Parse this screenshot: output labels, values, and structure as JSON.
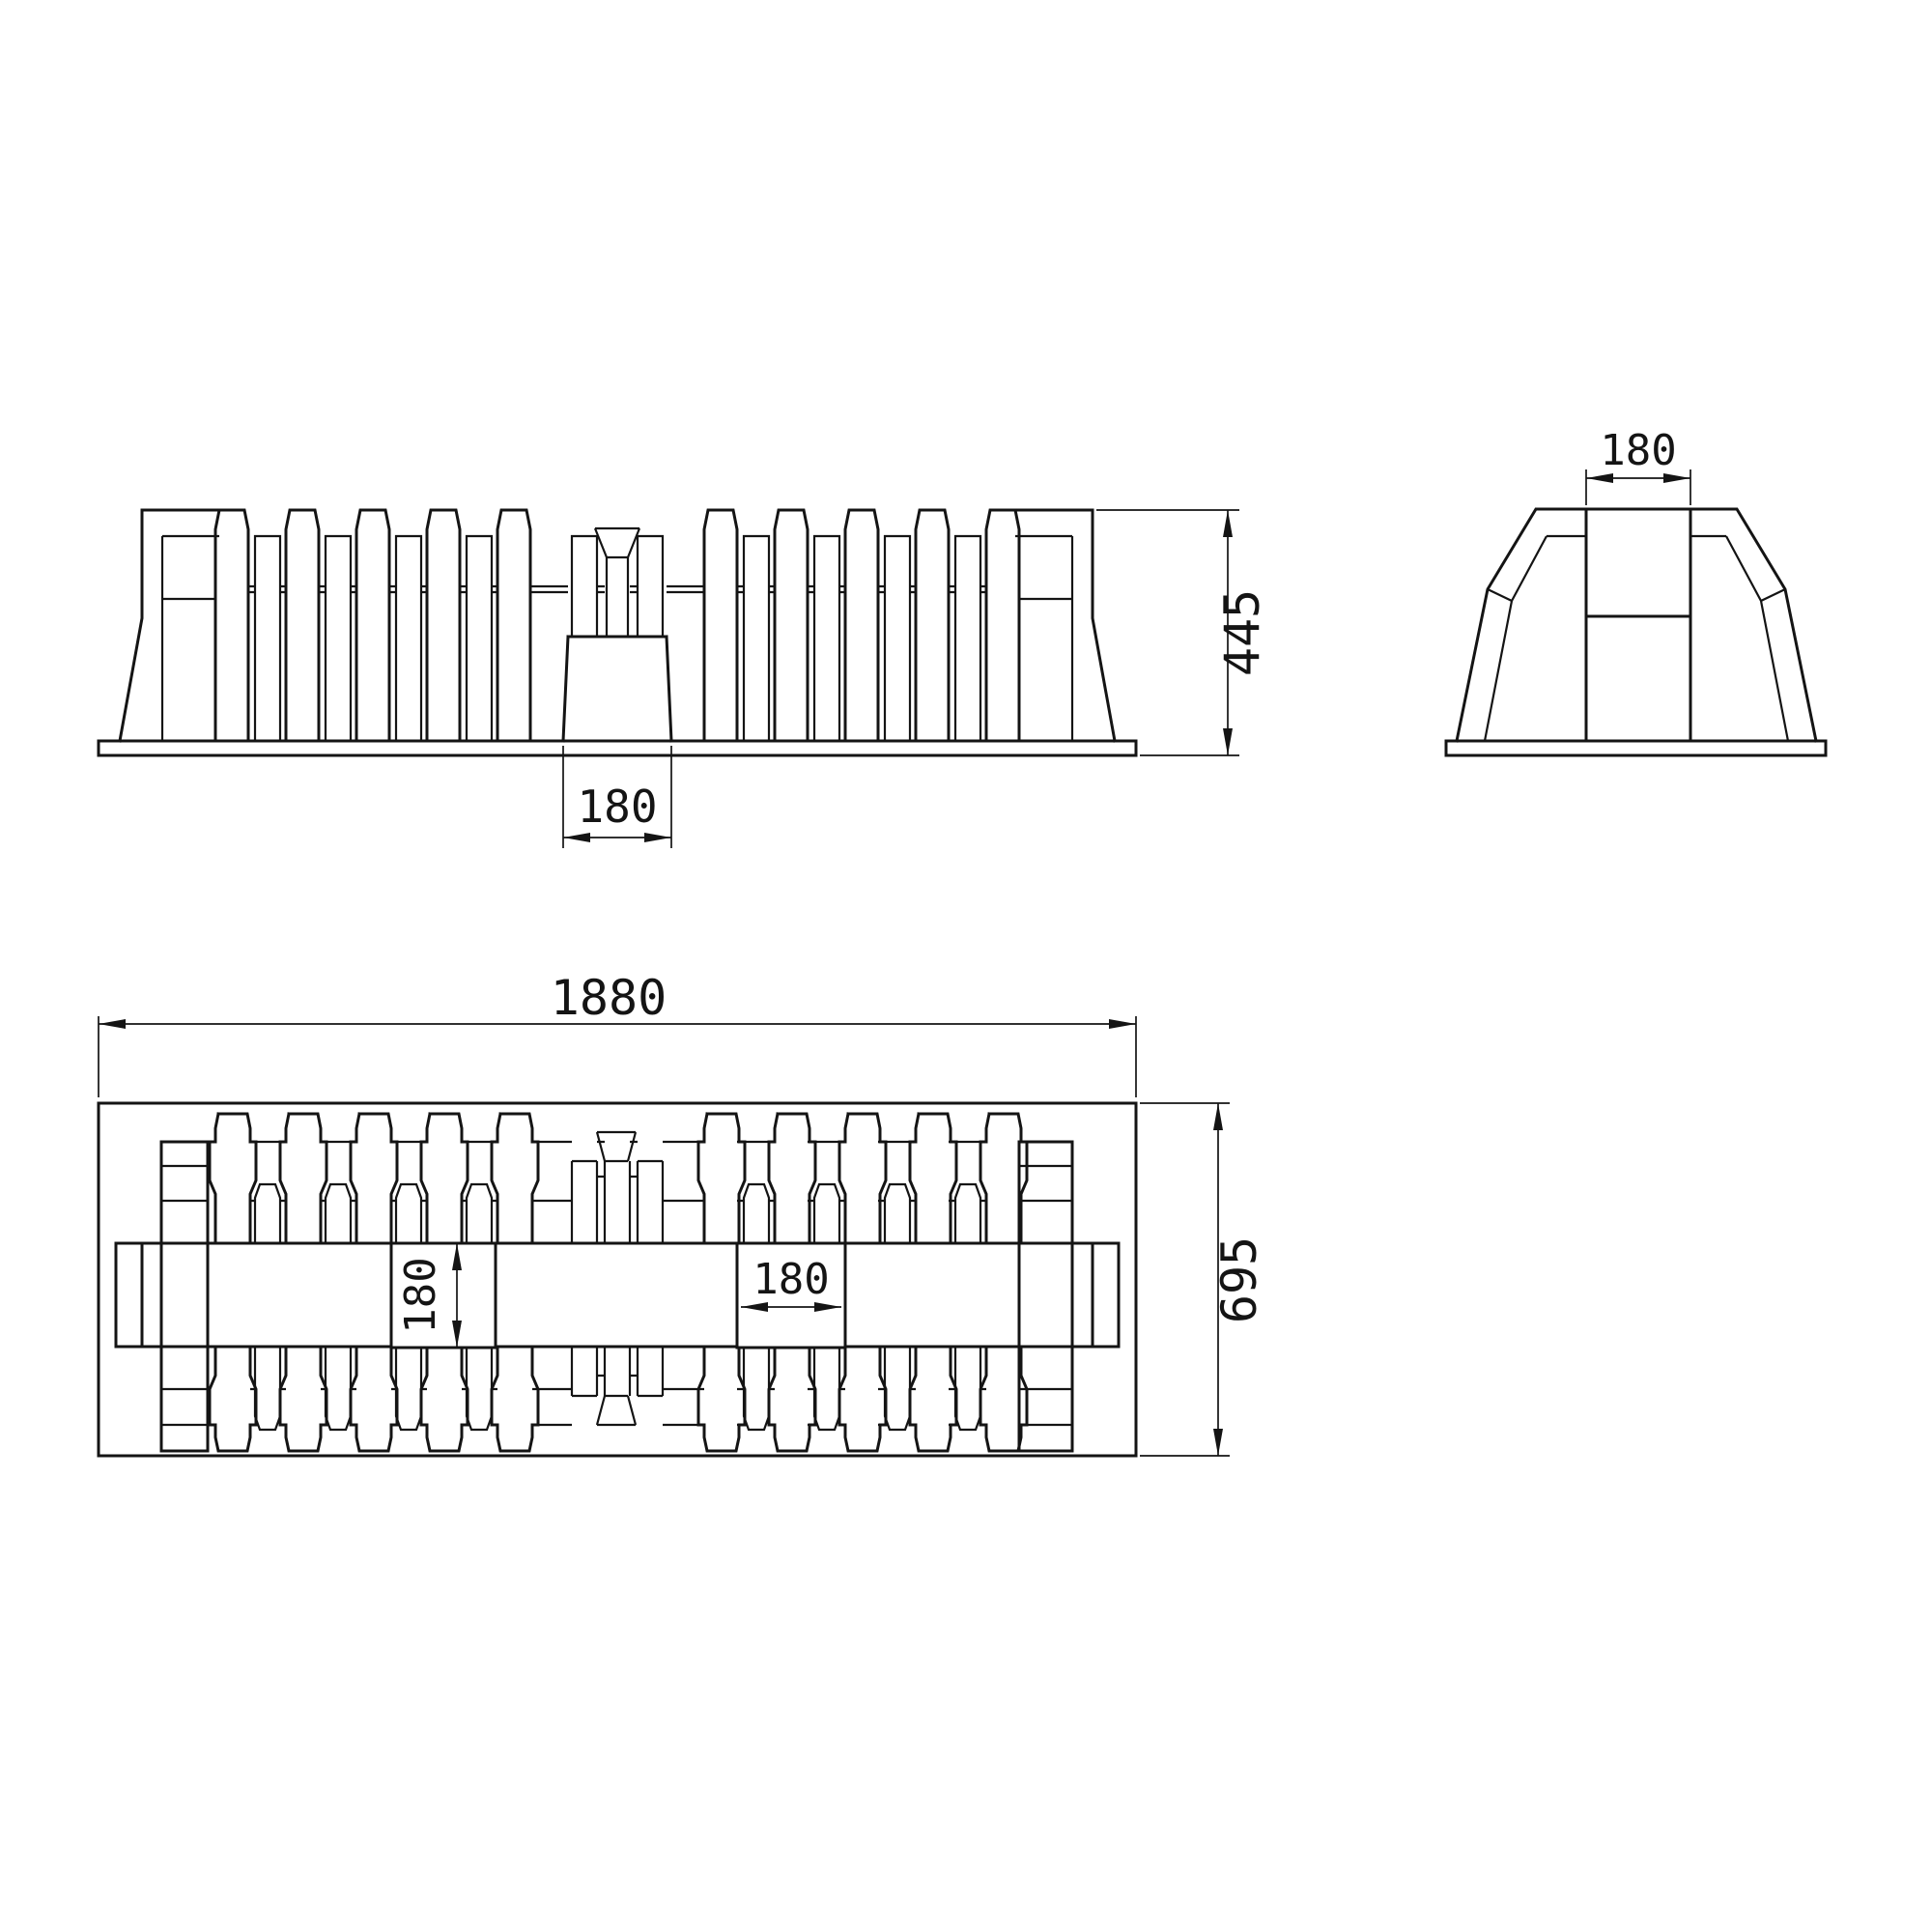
{
  "title": "technical-drawing-three-views",
  "colors": {
    "background": "#ffffff",
    "line": "#141414"
  },
  "views": {
    "front": {
      "name": "front-view",
      "dim_overall_height": "445",
      "dim_center_slot": "180"
    },
    "side": {
      "name": "side-view",
      "dim_top_slot": "180"
    },
    "plan": {
      "name": "plan-view",
      "dim_overall_width": "1880",
      "dim_overall_depth": "695",
      "dim_spine_height": "180",
      "dim_slot_width": "180"
    }
  }
}
